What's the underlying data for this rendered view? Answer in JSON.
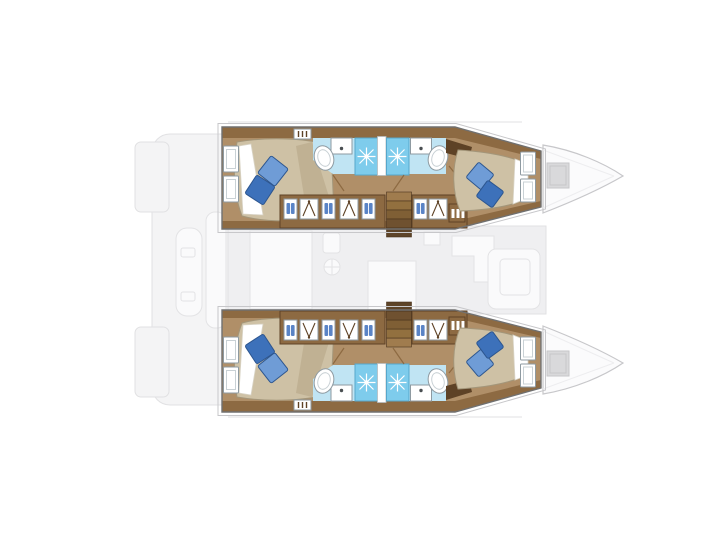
{
  "diagram": {
    "kind": "yacht floor plan",
    "vessel_type": "sailing catamaran",
    "view": "top-down deck plan",
    "bow_direction": "right",
    "highlight": "both hulls rendered in full color; salon, cockpit, transoms and bows rendered faint gray",
    "hulls": [
      {
        "name": "port hull (top)",
        "rooms": [
          "aft double cabin with hull windows",
          "aft bathroom (toilet, sink, shower)",
          "forward bathroom (shower, sink, toilet)",
          "forward double cabin with hull windows"
        ],
        "features": [
          "companionway stairs to salon",
          "wardrobe lockers with hangers and folded clothes",
          "drawer unit",
          "vent grille"
        ]
      },
      {
        "name": "starboard hull (bottom)",
        "rooms": [
          "aft double cabin with hull windows",
          "aft bathroom (toilet, sink, shower)",
          "forward bathroom (shower, sink, toilet)",
          "forward double cabin with hull windows"
        ],
        "features": [
          "companionway stairs to salon",
          "wardrobe lockers with hangers and folded clothes",
          "drawer unit",
          "vent grille"
        ]
      }
    ],
    "center": [
      "salon with galley sink and stove (faint)",
      "forward lounge seating (faint)",
      "aft cockpit with table (faint)",
      "twin transom platforms (faint)"
    ],
    "foredeck": [
      "port bow with deck hatch",
      "starboard bow with deck hatch"
    ],
    "icons": {
      "shower_drain": "starburst",
      "wardrobe": "clothes-hanger",
      "folded_clothes": "twin blue stacks",
      "galley_sink": "circle with cross",
      "bed_pillows": "rotated blue squares"
    },
    "counts": {
      "double_cabins": 4,
      "bathrooms": 4,
      "shower_stalls": 4,
      "companionway_stairs": 2,
      "deck_hatches": 2
    }
  },
  "colors": {
    "white": "#ffffff",
    "floor": "#b08f68",
    "wood": "#8d6a42",
    "wood_dark": "#5e4226",
    "duvet": "#cec1a5",
    "duvet_shade": "#b4a485",
    "duvet_edge": "#a3967a",
    "sheet_edge": "#d9d4c6",
    "pillow_light": "#6f9cd6",
    "pillow_dark": "#3d71ba",
    "pillow_edge": "#2d568f",
    "bath_floor": "#c0e4f3",
    "shower": "#7eccec",
    "shower_edge": "#56a7cb",
    "fixture": "#ffffff",
    "fixture_line": "#8e9aa1",
    "fixture_dot": "#4a4f52",
    "toilet_inner": "#c9d1d5",
    "divider_line": "#b7bcc0",
    "locker_item": "#5a84c6",
    "stair_1": "#a07c4e",
    "stair_2": "#92703f",
    "stair_3": "#7f5f35",
    "stair_4": "#6f5130",
    "stair_5": "#5e4428",
    "stair_edge": "#49331d",
    "hull_outline": "#707070",
    "deck_edge": "#c7c7ca",
    "deck_faint_fill": "#f4f4f5",
    "deck_faint_line": "#e1e1e3",
    "salon_fill": "#efeff1",
    "furn_fill": "#fafafb",
    "furn_line": "#e3e3e5",
    "bow_fill": "#fbfbfc",
    "bow_ridge": "#ededef",
    "bow_hatch": "#d9d9db",
    "bow_hatch_line": "#c6c6c8"
  }
}
